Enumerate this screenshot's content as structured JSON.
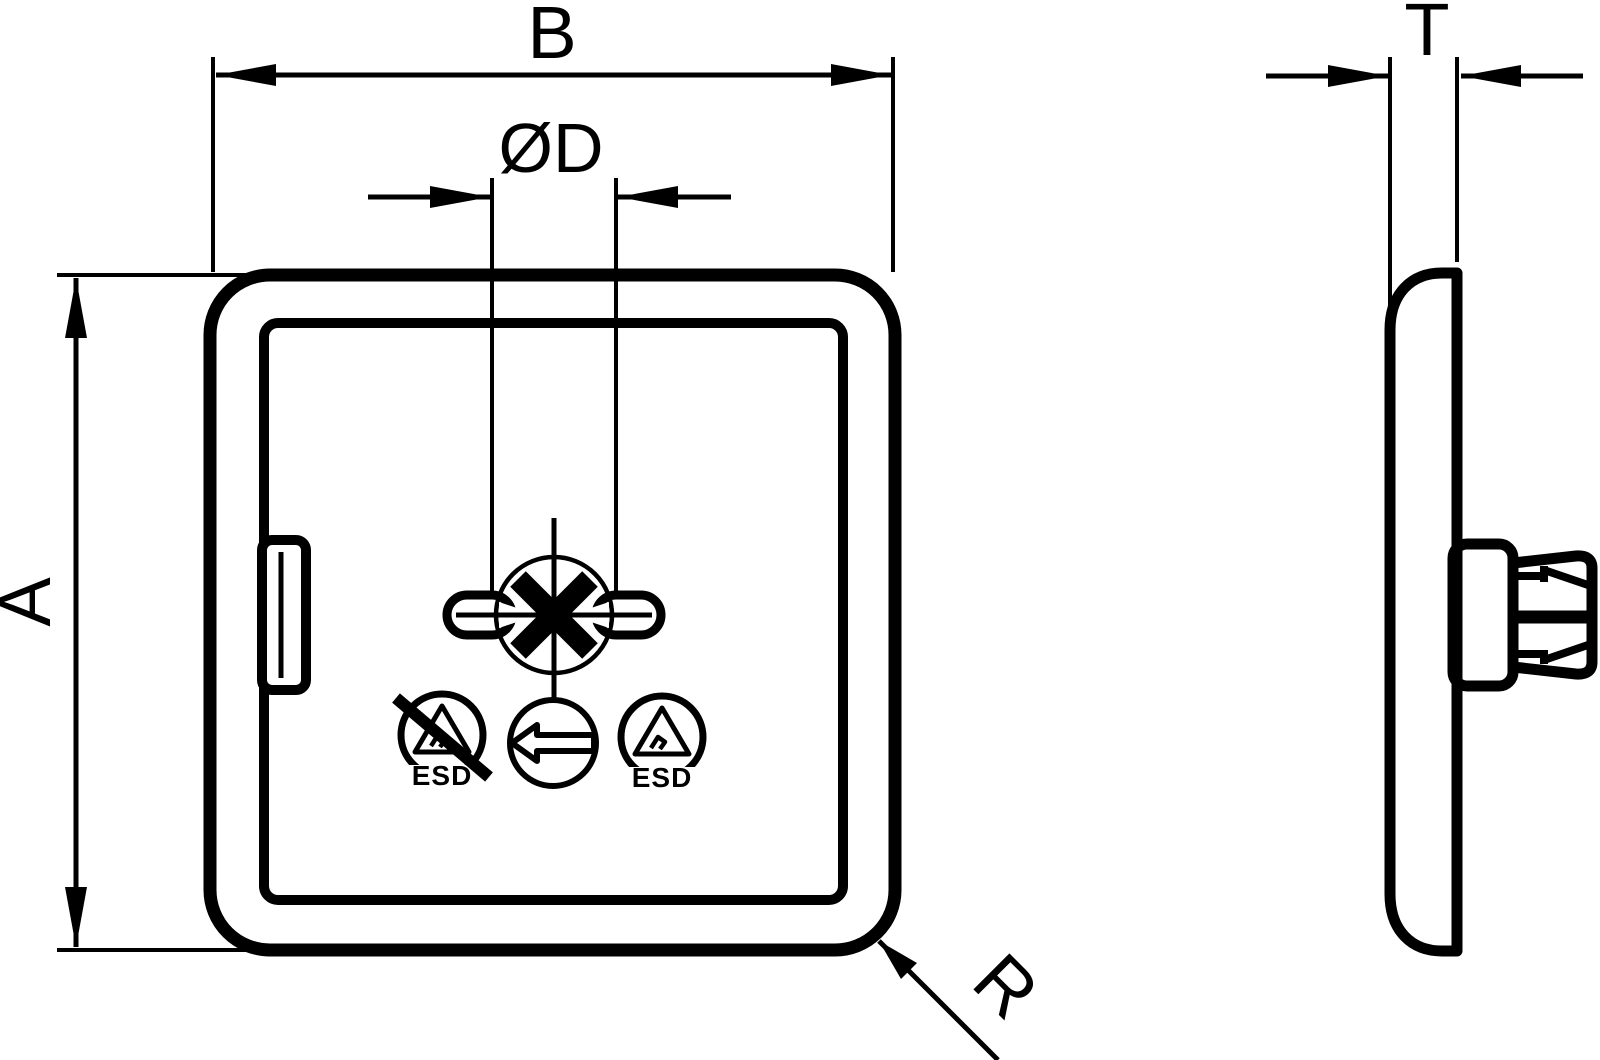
{
  "drawing": {
    "background_color": "#ffffff",
    "line_color": "#000000",
    "views": {
      "front_view": "protective cover front view with cross slot, latch tab and ESD markings",
      "side_view": "protective cover side profile with knurled pull knob"
    },
    "dimension_labels": {
      "width": "B",
      "slot_diameter": "ØD",
      "height": "A",
      "thickness": "T",
      "corner_radius": "R"
    },
    "symbol_labels": {
      "esd_prohibited_text": "ESD",
      "esd_protected_text": "ESD"
    }
  }
}
